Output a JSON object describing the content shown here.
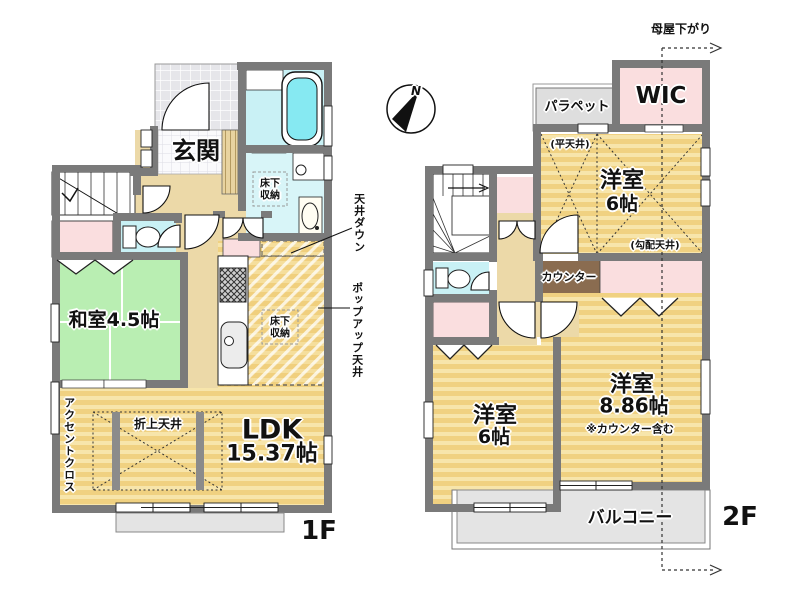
{
  "compass": {
    "north": "N"
  },
  "floor1": {
    "floor_label": "1F",
    "genkan": "玄関",
    "washitsu": "和室4.5帖",
    "ldk_name": "LDK",
    "ldk_size": "15.37帖",
    "underfloor_storage_washroom": "床下収納",
    "underfloor_storage_kitchen": "床下収納",
    "coffered_ceiling": "折上天井",
    "accent_cross": "アクセントクロス",
    "ceiling_down": "天井ダウン",
    "popup_ceiling": "ポップアップ天井"
  },
  "floor2": {
    "floor_label": "2F",
    "moya_sagari": "母屋下がり",
    "parapet": "パラペット",
    "wic": "WIC",
    "flat_ceiling": "(平天井)",
    "room6_top_name": "洋室",
    "room6_top_size": "6帖",
    "sloped_ceiling": "(勾配天井)",
    "counter": "カウンター",
    "room886_name": "洋室",
    "room886_size": "8.86帖",
    "counter_note": "※カウンター含む",
    "room6_bottom_name": "洋室",
    "room6_bottom_size": "6帖",
    "balcony": "バルコニー"
  },
  "colors": {
    "wall": "#7a7a7a",
    "wood_floor": "#f0d181",
    "wood_stripe": "#f7e5ab",
    "tatami_green": "#b9eeb2",
    "closet_pink": "#fadedf",
    "bath_cyan": "#c9f1f5",
    "washroom_cyan": "#d8f5f8",
    "tub_cyan": "#86e9f2",
    "hall_beige": "#ecd9a8",
    "counter_brown": "#8a6c50",
    "porch_gray": "#e4e4e4",
    "parapet_gray": "#dedede"
  }
}
